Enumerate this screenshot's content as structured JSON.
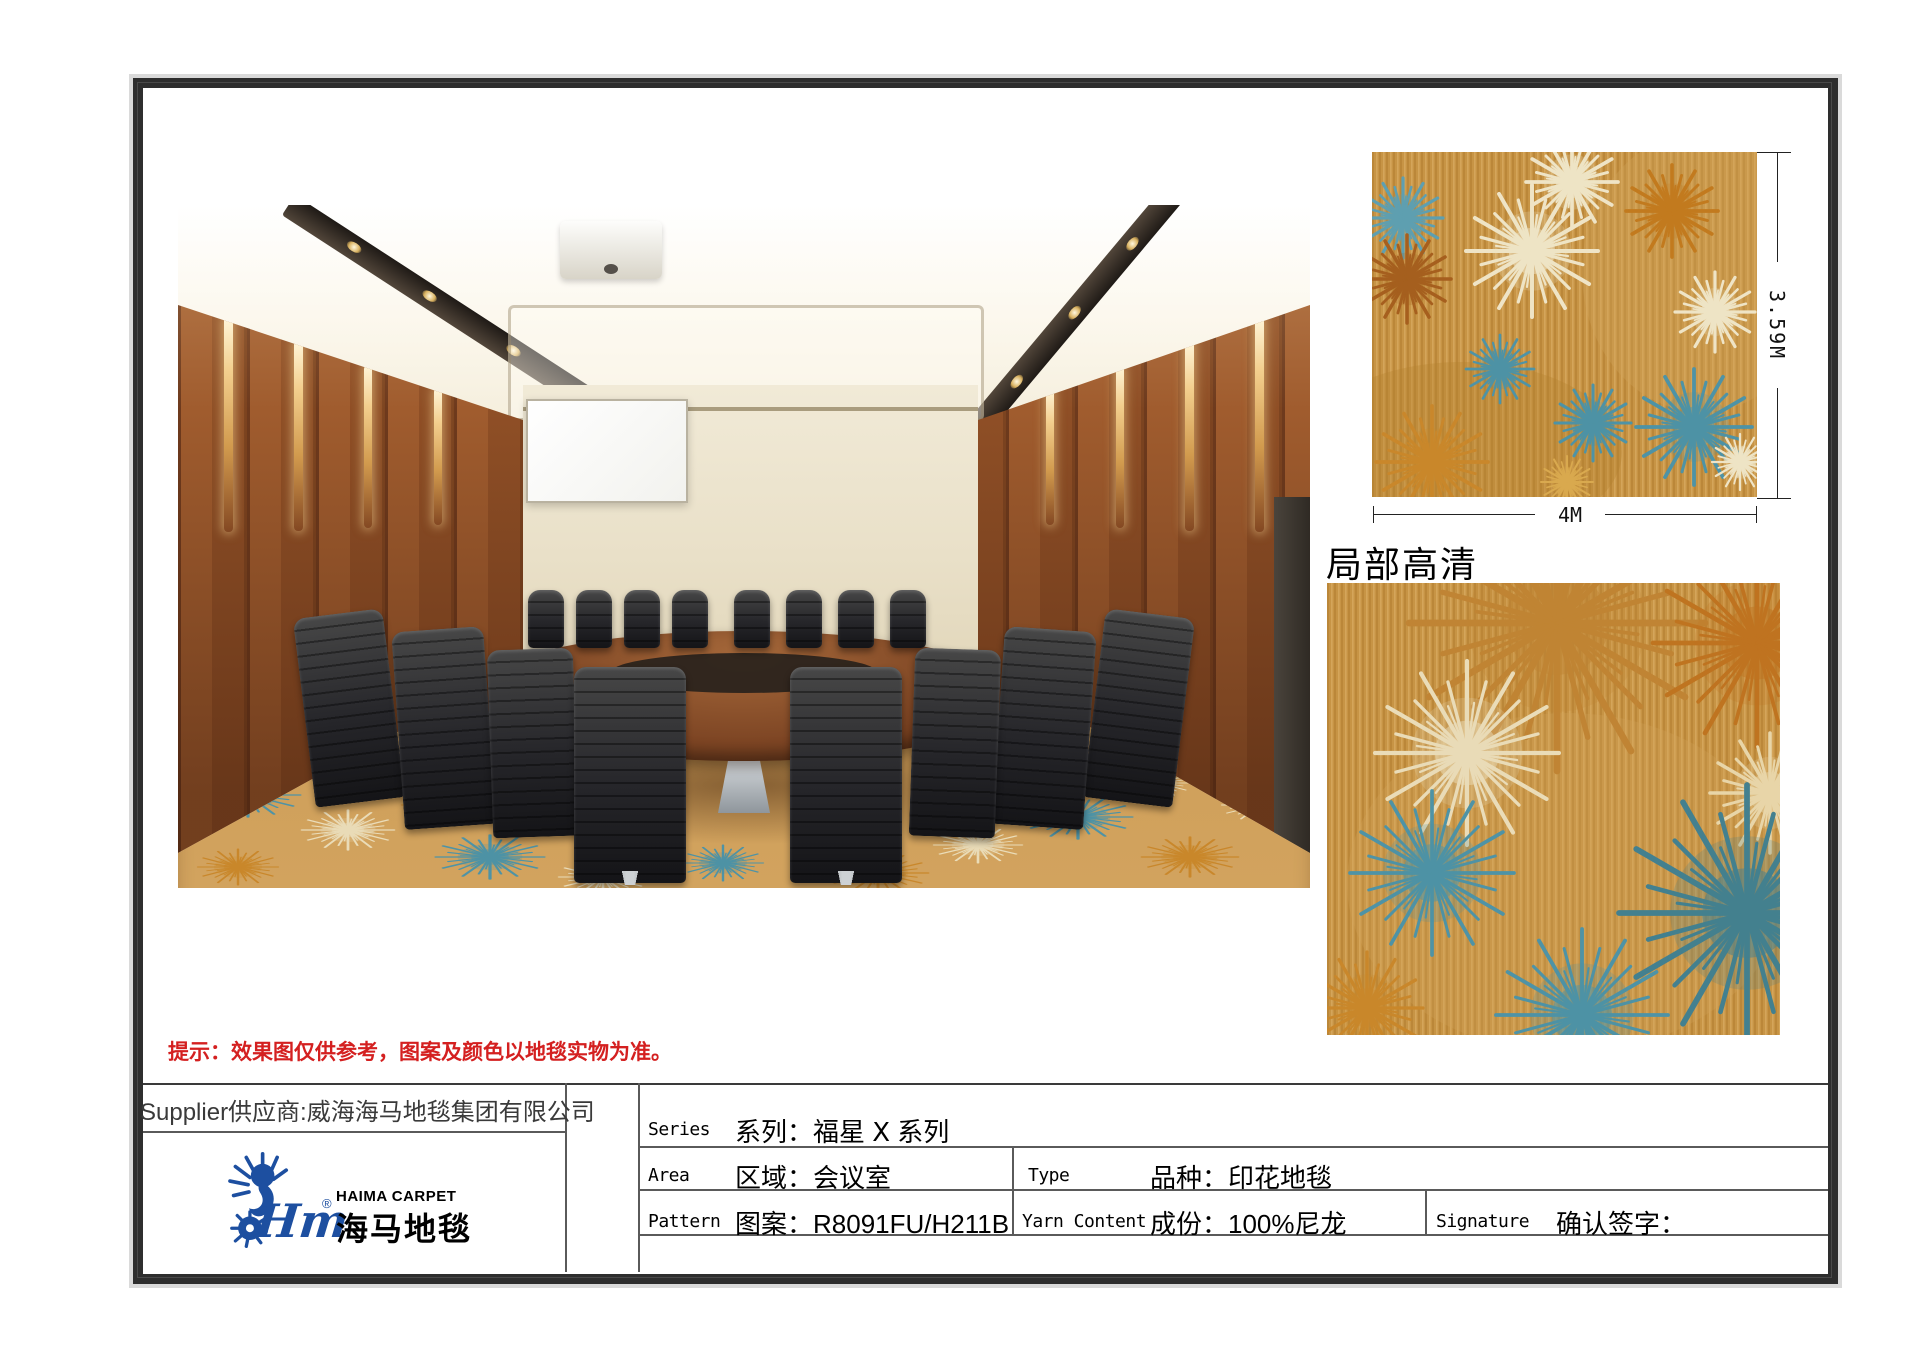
{
  "page": {
    "hint": "提示：效果图仅供参考，图案及颜色以地毯实物为准。",
    "detail_title": "局部高清"
  },
  "swatch": {
    "width_label": "4M",
    "height_label": "3.59M"
  },
  "supplier": {
    "label": "Supplier供应商:威海海马地毯集团有限公司"
  },
  "logo": {
    "icon": "seahorse-logo-icon",
    "script": "Hm",
    "registered": "®",
    "name_en": "HAIMA CARPET",
    "name_cn": "海马地毯",
    "brand_blue": "#1d4fa0"
  },
  "spec_table": {
    "series": {
      "label": "Series",
      "value": "系列：福星 Ⅹ 系列"
    },
    "area": {
      "label": "Area",
      "value": "区域：会议室"
    },
    "type": {
      "label": "Type",
      "value": "品种：印花地毯"
    },
    "pattern": {
      "label": "Pattern",
      "value": "图案：R8091FU/H211B"
    },
    "yarn_content": {
      "label": "Yarn Content",
      "value": "成份：100%尼龙"
    },
    "signature": {
      "label": "Signature",
      "value": "确认签字："
    }
  },
  "colors": {
    "hint_red": "#d42020",
    "frame_dark": "#2e2e2e",
    "carpet_base": "#c79445",
    "carpet_blue": "#4e93a6",
    "carpet_cream": "#eadcb8",
    "carpet_orange": "#c9872b",
    "carpet_rust": "#a65f1e"
  }
}
